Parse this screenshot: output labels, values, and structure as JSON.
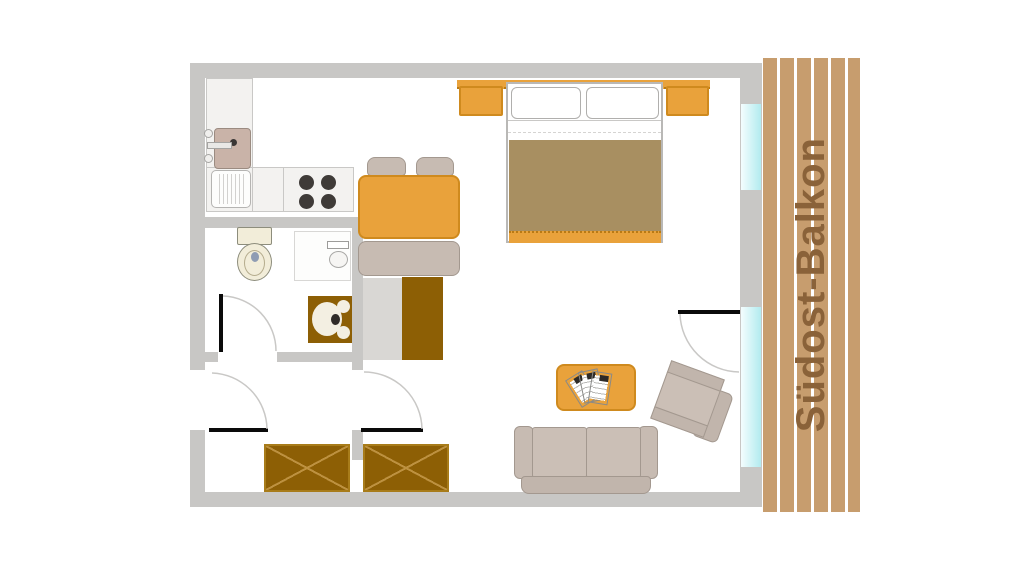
{
  "balcony": {
    "label": "Südost-Balkon"
  },
  "palette": {
    "wall": "#c8c7c5",
    "wall_light": "#d9d7d4",
    "floor": "#ffffff",
    "orange": "#e9a23b",
    "orange_border": "#cf8a1e",
    "dark_wood": "#8d5f05",
    "wood_cross": "#bd9140",
    "plank": "#c79d6e",
    "balcony_text": "#8a6239",
    "taupe": "#c7bbb2",
    "taupe_border": "#a3988f",
    "cushion": "#cbbfb6",
    "blanket": "#a88f61",
    "window": "#b2ebef",
    "cream": "#f2edd9",
    "cream_border": "#8d8d7c",
    "counter": "#f3f2f0",
    "counter_border": "#c9c8c6",
    "kitchen_sink": "#c9b3a8",
    "burner": "#3f3b38",
    "door_line": "#0a0a0a"
  },
  "furniture_icons": [
    "kitchen-sink-icon",
    "drainboard-icon",
    "stove-icon",
    "toilet-icon",
    "washbasin-icon",
    "shower-icon",
    "dining-table-icon",
    "chair-icon",
    "bench-icon",
    "cabinet-icon",
    "double-bed-icon",
    "nightstand-icon",
    "coffee-table-icon",
    "newspaper-icon",
    "sofa-icon",
    "armchair-icon",
    "wardrobe-icon",
    "door-icon",
    "window-icon"
  ]
}
